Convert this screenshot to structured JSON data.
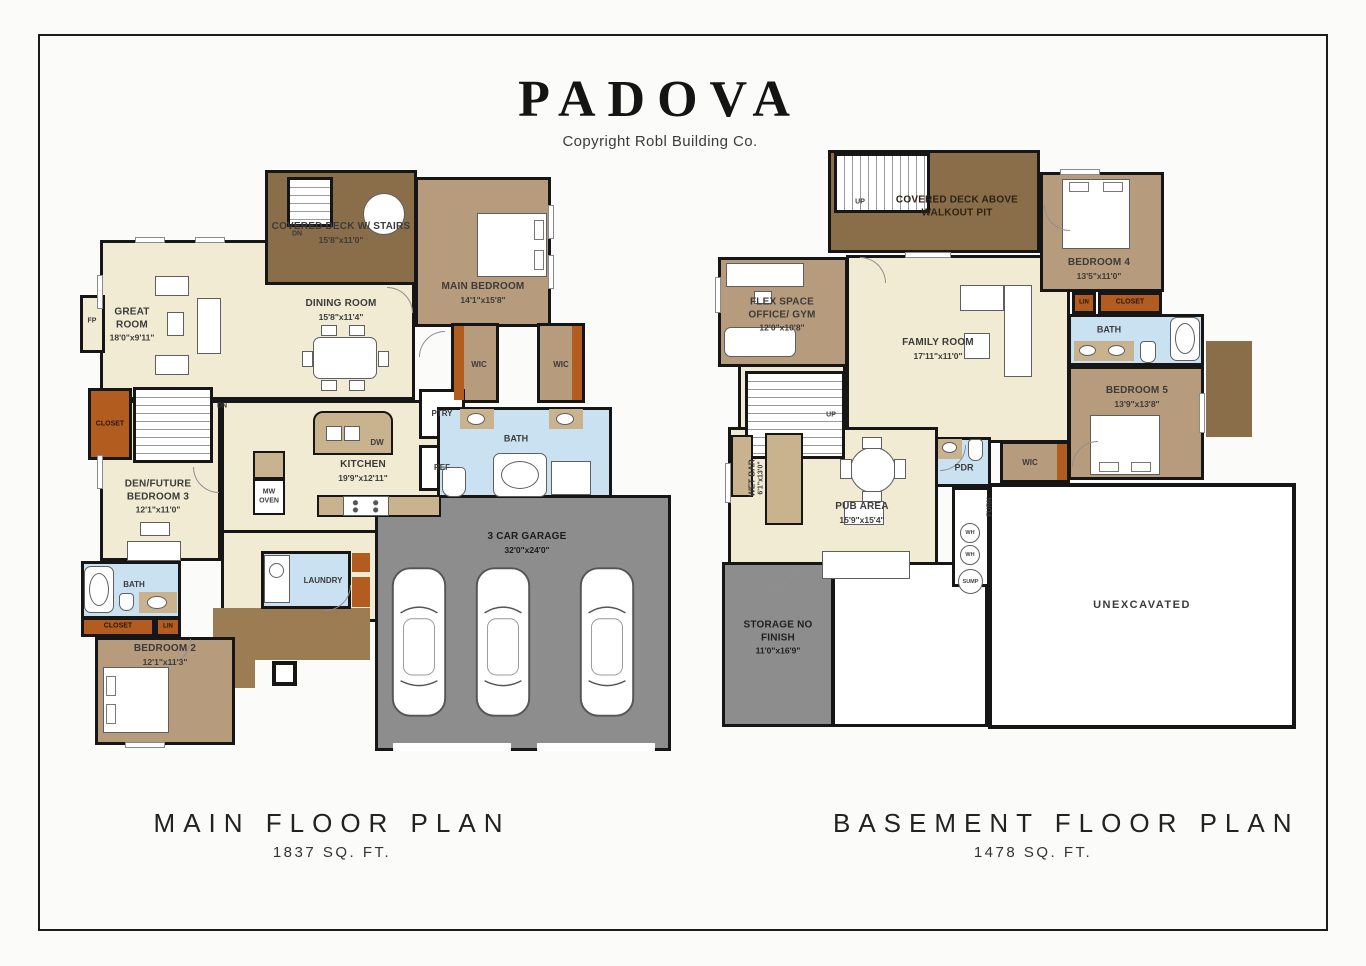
{
  "header": {
    "title": "PADOVA",
    "copyright": "Copyright Robl Building Co."
  },
  "footer": {
    "m_title": "MAIN FLOOR PLAN",
    "m_sqft": "1837 SQ. FT.",
    "b_title": "BASEMENT FLOOR PLAN",
    "b_sqft": "1478 SQ. FT."
  },
  "mf": {
    "deck_name": "COVERED DECK W/ STAIRS",
    "deck_dims": "15'8\"x11'0\"",
    "main_bedroom_name": "MAIN BEDROOM",
    "main_bedroom_dims": "14'1\"x15'8\"",
    "great_room_name": "GREAT ROOM",
    "great_room_dims": "18'0\"x9'11\"",
    "dining_name": "DINING ROOM",
    "dining_dims": "15'8\"x11'4\"",
    "kitchen_name": "KITCHEN",
    "kitchen_dims": "19'9\"x12'11\"",
    "den_name": "DEN/FUTURE BEDROOM 3",
    "den_dims": "12'1\"x11'0\"",
    "bedroom2_name": "BEDROOM 2",
    "bedroom2_dims": "12'1\"x11'3\"",
    "garage_name": "3 CAR GARAGE",
    "garage_dims": "32'0\"x24'0\"",
    "bath": "BATH",
    "bath2": "BATH",
    "laundry": "LAUNDRY",
    "closet": "CLOSET",
    "closet2": "CLOSET",
    "lin": "LIN",
    "wic": "WIC",
    "ptry": "PTRY",
    "ref": "REF",
    "dw": "DW",
    "mw": "MW OVEN",
    "fp": "FP",
    "dn": "DN"
  },
  "bm": {
    "deck_name": "COVERED DECK ABOVE WALKOUT PIT",
    "flex_name": "FLEX SPACE OFFICE/ GYM",
    "flex_dims": "12'0\"x10'8\"",
    "family_name": "FAMILY ROOM",
    "family_dims": "17'11\"x11'0\"",
    "bedroom4_name": "BEDROOM 4",
    "bedroom4_dims": "13'5\"x11'0\"",
    "bedroom5_name": "BEDROOM 5",
    "bedroom5_dims": "13'9\"x13'8\"",
    "pub_name": "PUB AREA",
    "pub_dims": "15'9\"x15'4\"",
    "wetbar_name": "WET BAR",
    "wetbar_dims": "6'1\"x13'0\"",
    "storage_name": "STORAGE NO FINISH",
    "storage_dims": "11'0\"x16'9\"",
    "unexcavated": "UNEXCAVATED",
    "bath": "BATH",
    "pdr": "PDR",
    "wic": "WIC",
    "lin": "LIN",
    "closet": "CLOSET",
    "furn": "FURN",
    "wh": "WH",
    "sump": "SUMP",
    "up": "UP"
  },
  "colors": {
    "wall": "#161616",
    "floor_cream": "#f1ebd4",
    "room_tan": "#b79b7d",
    "deck_brown": "#8a6e4a",
    "closet_orange": "#b25c1f",
    "bath_blue": "#cae1f2",
    "garage_gray": "#8d8d8d",
    "counter_granite": "#c9b28e",
    "porch_brown": "#9c7c53"
  }
}
